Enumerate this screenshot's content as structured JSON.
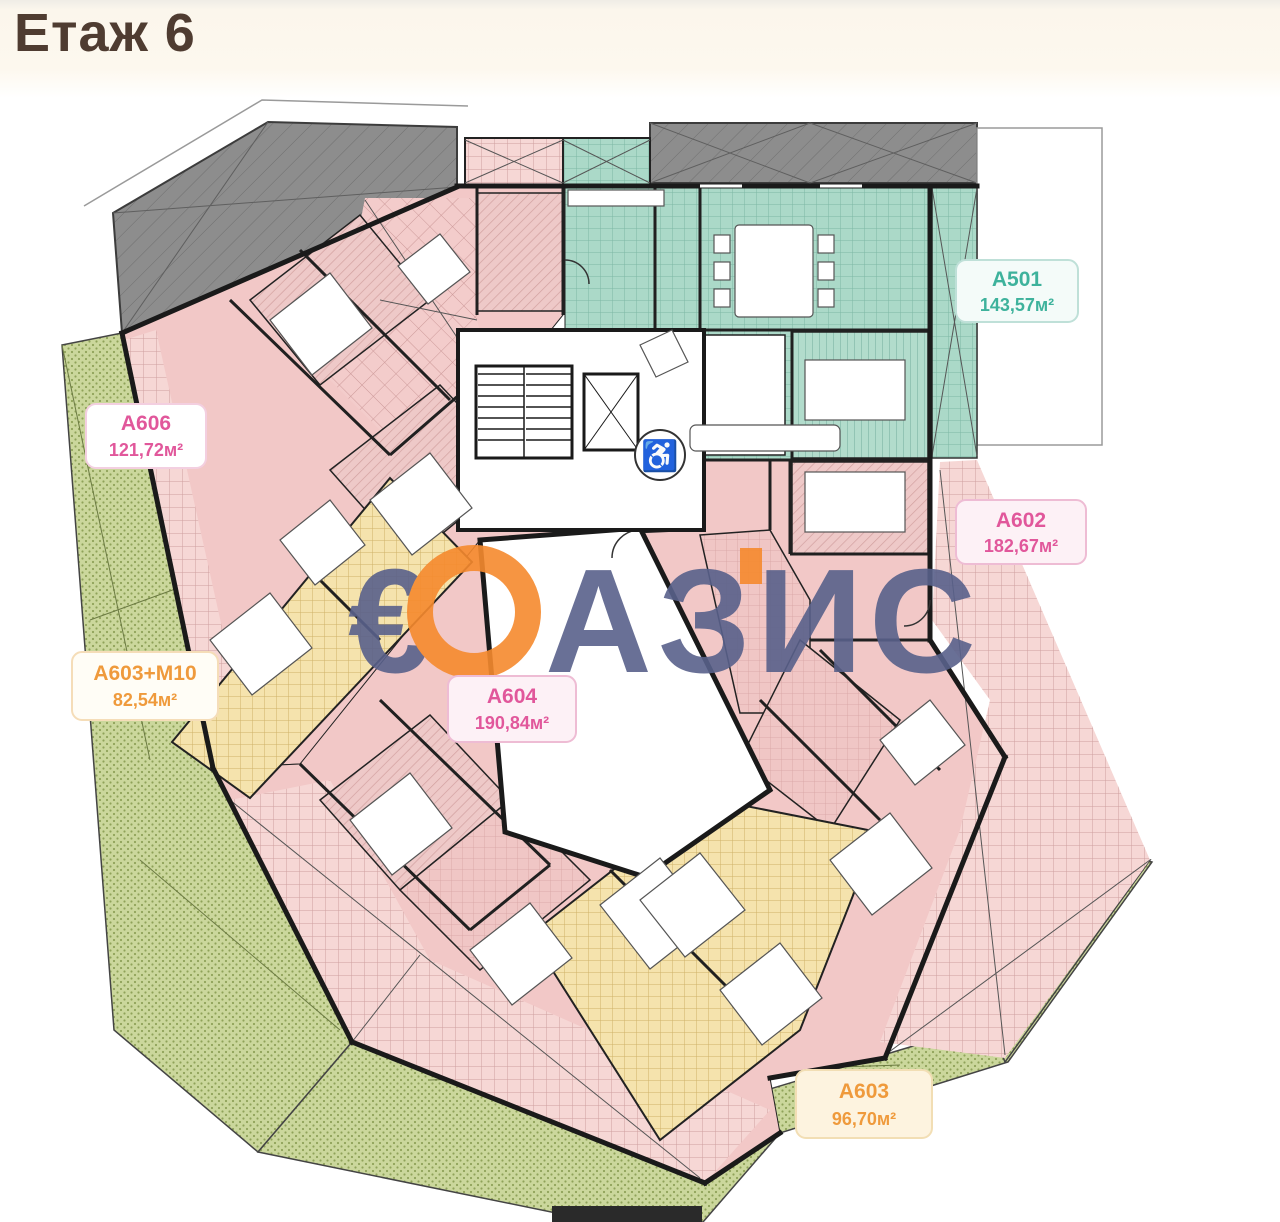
{
  "header": {
    "title": "Етаж 6",
    "title_color": "#4f3c31"
  },
  "watermark": {
    "text": "ОАЗИС",
    "euro_symbol": "€",
    "letters_after_logo": "АЗИС",
    "blue": "#59618b",
    "orange": "#f68a2e"
  },
  "apartments": [
    {
      "id": "A606",
      "area": "121,72м²",
      "zone": "pink",
      "label_color": "#e1579b"
    },
    {
      "id": "A603+M10",
      "area": "82,54м²",
      "zone": "yellow",
      "label_color": "#ef9a3c"
    },
    {
      "id": "A604",
      "area": "190,84м²",
      "zone": "pink",
      "label_color": "#e1579b"
    },
    {
      "id": "A501",
      "area": "143,57м²",
      "zone": "teal",
      "label_color": "#3eb29c"
    },
    {
      "id": "A602",
      "area": "182,67м²",
      "zone": "pink",
      "label_color": "#e1579b"
    },
    {
      "id": "A603",
      "area": "96,70м²",
      "zone": "yellow",
      "label_color": "#ef9a3c"
    }
  ],
  "plan_colors": {
    "apartment_pink": "#f2c8c7",
    "terrace_pink_hatch": "#f6d7d5",
    "apartment_teal": "#abd9c8",
    "apartment_yellow": "#f5e3ad",
    "terrace_green": "#cbd79c",
    "roof_gray": "#8d8d8d",
    "walls": "#1a1a1a"
  },
  "icons": {
    "wheelchair": "♿"
  }
}
